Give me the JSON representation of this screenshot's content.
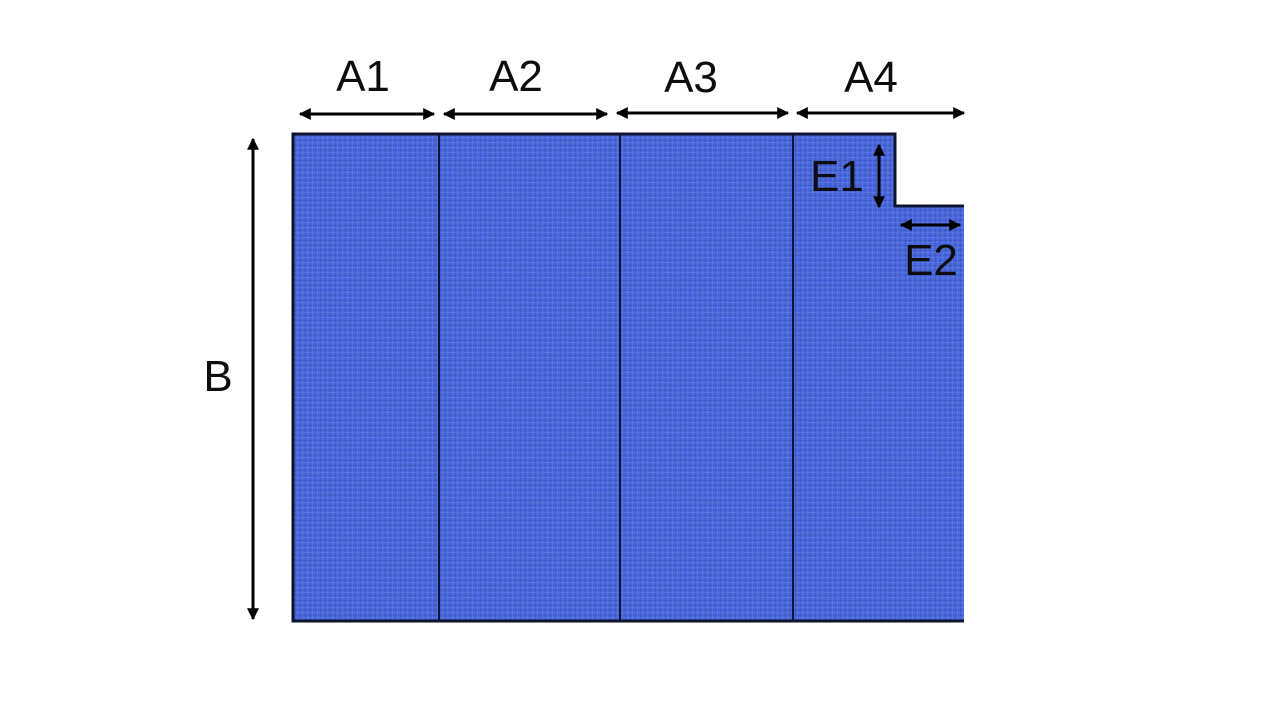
{
  "diagram": {
    "title": "panel-width-height-dimension-diagram",
    "labels": {
      "a1": "A1",
      "a2": "A2",
      "a3": "A3",
      "a4": "A4",
      "b": "B",
      "e1": "E1",
      "e2": "E2"
    },
    "colors": {
      "background": "#FFFFFF",
      "fabric_base": "#4968E3",
      "fabric_dark_thread": "#3550C2",
      "fabric_light_thread": "#6583F0",
      "outline": "#10132E",
      "divider": "#131538",
      "arrow": "#000000",
      "label_text": "#0D0D0D"
    }
  }
}
